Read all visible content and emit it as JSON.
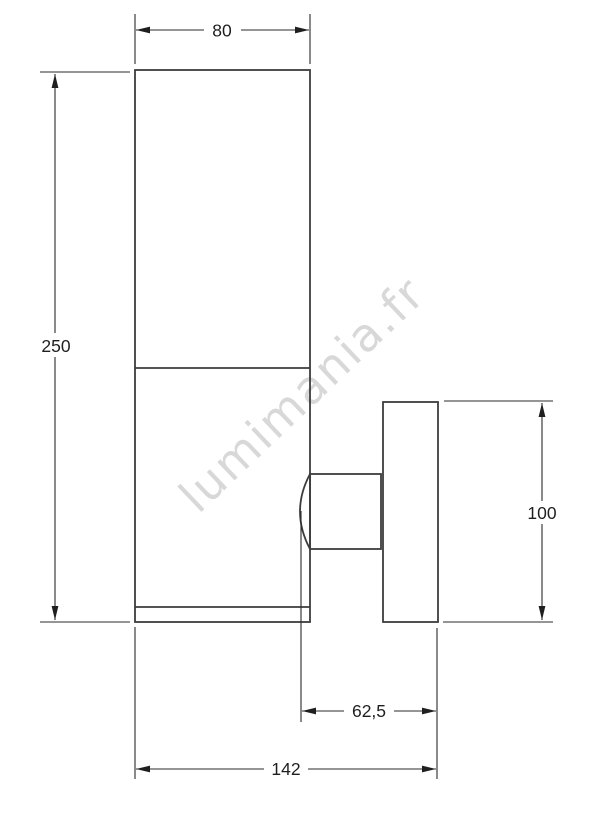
{
  "watermark": {
    "text": "lumimania.fr",
    "color": "#d8d8d8"
  },
  "drawing": {
    "object_line_color": "#3c3c3c",
    "dimension_line_color": "#2b2b2b",
    "dimensions": {
      "body_width": "80",
      "body_height": "250",
      "plate_height": "100",
      "projection": "62,5",
      "total_depth": "142"
    }
  }
}
